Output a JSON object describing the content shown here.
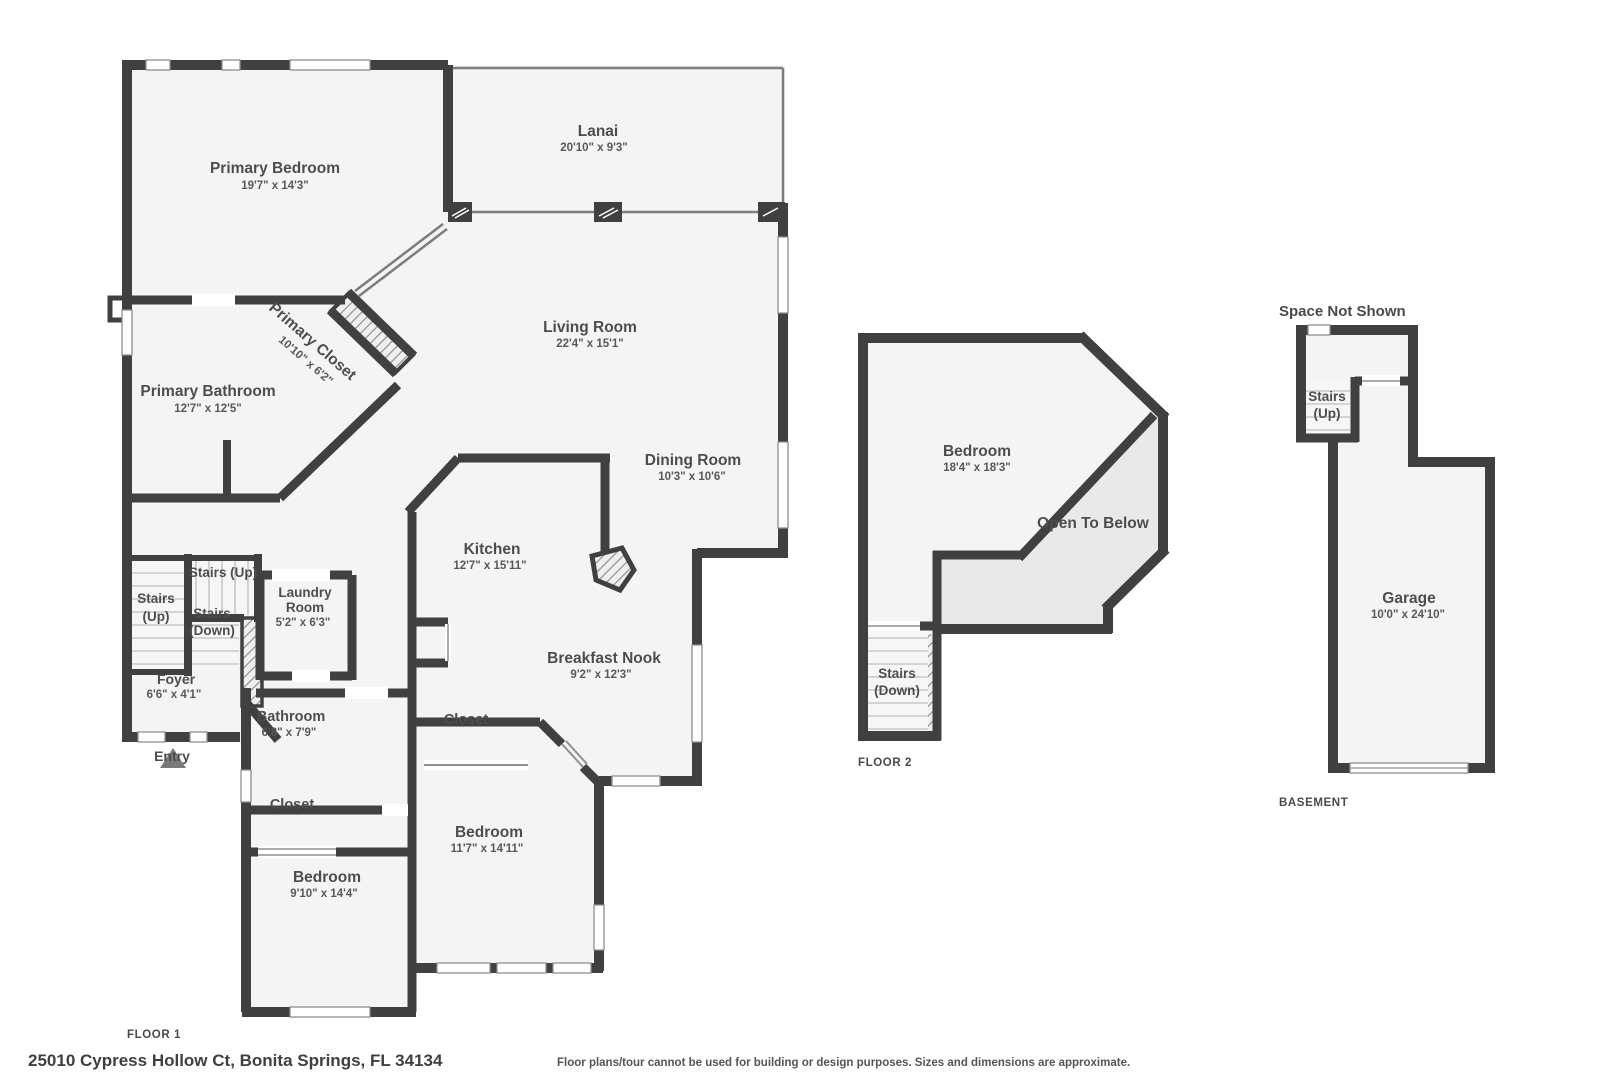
{
  "colors": {
    "wall": "#404040",
    "room_fill": "#f4f4f4",
    "open_below_fill": "#e9e9e9",
    "screen_line": "#7d7d7d",
    "window_frame": "#8f8f8f",
    "tread_line": "#c8c8c8",
    "hatch_line": "#909090",
    "label_text": "#4d4d4d"
  },
  "floor1": {
    "label": "FLOOR 1",
    "entry_label": "Entry",
    "rooms": {
      "primary_bedroom": {
        "name": "Primary Bedroom",
        "dims": "19'7\" x 14'3\""
      },
      "lanai": {
        "name": "Lanai",
        "dims": "20'10\" x 9'3\""
      },
      "living": {
        "name": "Living Room",
        "dims": "22'4\" x 15'1\""
      },
      "primary_closet": {
        "name": "Primary Closet",
        "dims": "10'10\" x 6'2\""
      },
      "primary_bath": {
        "name": "Primary Bathroom",
        "dims": "12'7\" x 12'5\""
      },
      "dining": {
        "name": "Dining Room",
        "dims": "10'3\" x 10'6\""
      },
      "kitchen": {
        "name": "Kitchen",
        "dims": "12'7\" x 15'11\""
      },
      "nook": {
        "name": "Breakfast Nook",
        "dims": "9'2\" x 12'3\""
      },
      "laundry": {
        "line1": "Laundry",
        "line2": "Room",
        "dims": "5'2\" x 6'3\""
      },
      "foyer": {
        "name": "Foyer",
        "dims": "6'6\" x 4'1\""
      },
      "bath": {
        "name": "Bathroom",
        "dims": "6'8\" x 7'9\""
      },
      "closet_left": {
        "name": "Closet"
      },
      "closet_right": {
        "name": "Closet"
      },
      "bedroom_left": {
        "name": "Bedroom",
        "dims": "9'10\" x 14'4\""
      },
      "bedroom_right": {
        "name": "Bedroom",
        "dims": "11'7\" x 14'11\""
      },
      "stairs_up_main": {
        "line1": "Stairs",
        "line2": "(Up)"
      },
      "stairs_up_small": {
        "line1": "Stairs (Up)"
      },
      "stairs_down": {
        "line1": "Stairs",
        "line2": "(Down)"
      }
    }
  },
  "floor2": {
    "label": "FLOOR 2",
    "bedroom": {
      "name": "Bedroom",
      "dims": "18'4\" x 18'3\""
    },
    "open_to_below": "Open To Below",
    "stairs_down": {
      "line1": "Stairs",
      "line2": "(Down)"
    }
  },
  "basement": {
    "label": "BASEMENT",
    "space_not_shown": "Space Not Shown",
    "stairs_up": {
      "line1": "Stairs",
      "line2": "(Up)"
    },
    "garage": {
      "name": "Garage",
      "dims": "10'0\" x 24'10\""
    }
  },
  "footer": {
    "address": "25010 Cypress Hollow Ct, Bonita Springs, FL 34134",
    "disclaimer": "Floor plans/tour cannot be used for building or design purposes. Sizes and dimensions are approximate."
  }
}
